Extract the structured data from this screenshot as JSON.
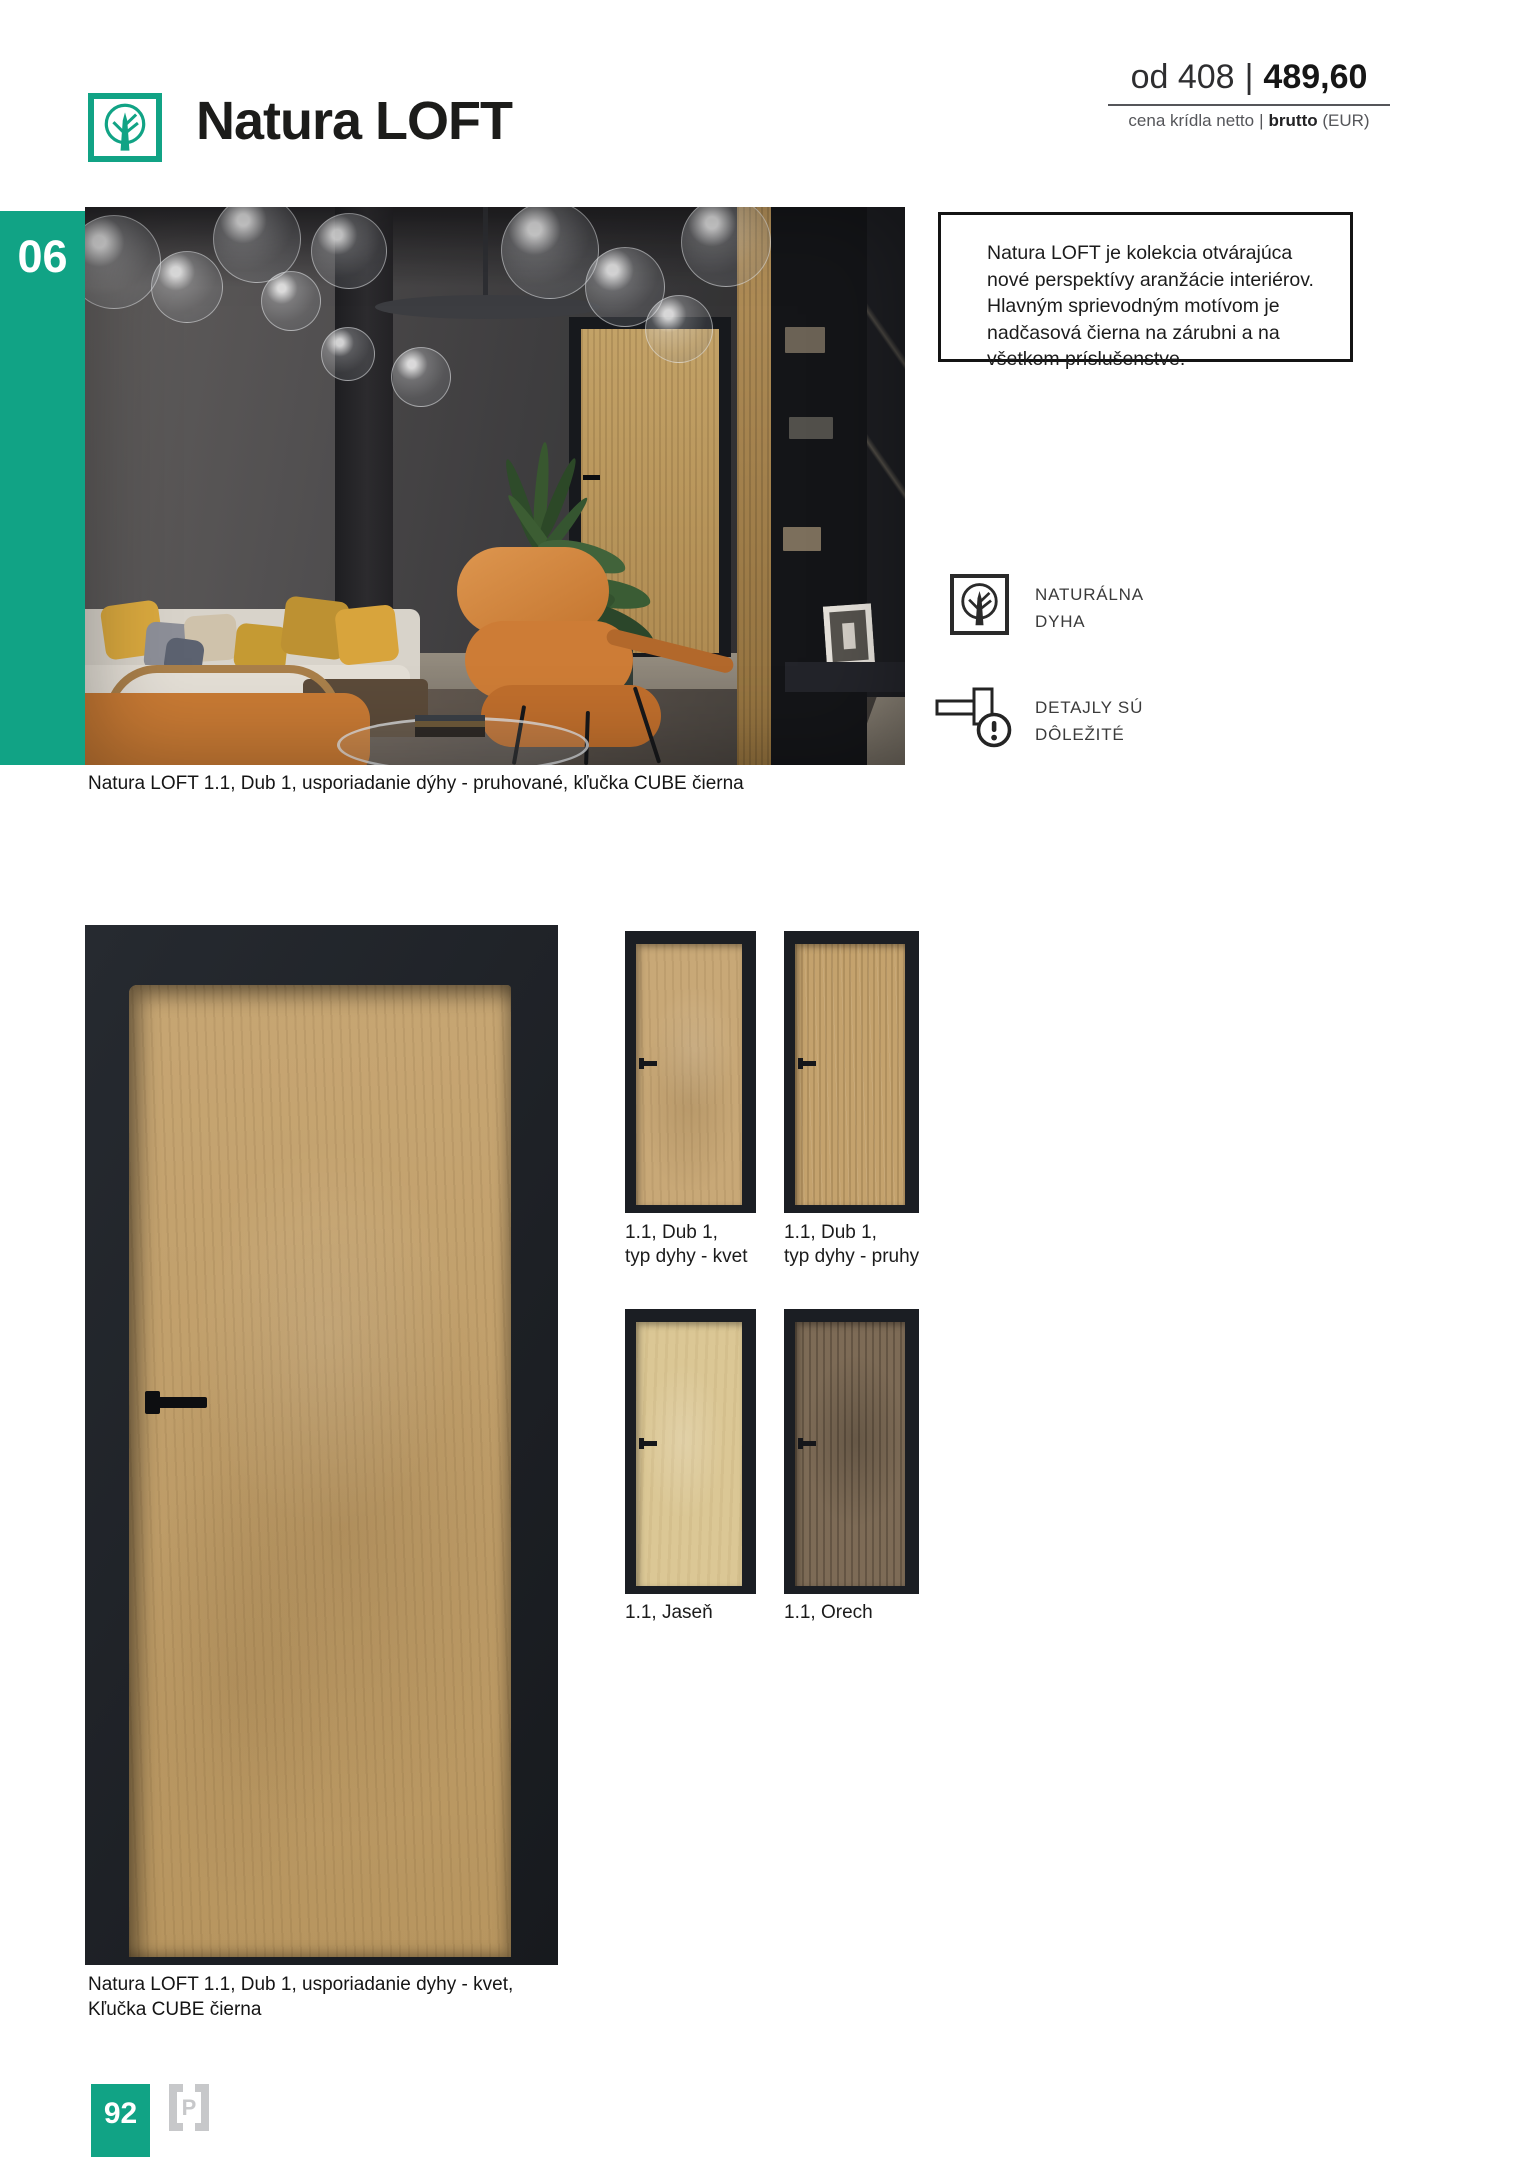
{
  "colors": {
    "accent_teal": "#11a385",
    "frame_black": "#1b1e23",
    "title_ink": "#1c1c1a"
  },
  "header": {
    "title": "Natura LOFT",
    "price": {
      "prefix": "od 408",
      "separator": "|",
      "value_bold": "489,60"
    },
    "price_caption": {
      "regular": "cena krídla netto",
      "separator": "|",
      "bold": "brutto",
      "suffix": "(EUR)"
    }
  },
  "sidebar": {
    "chapter_number": "06"
  },
  "hero": {
    "info_box_text": "Natura LOFT je kolekcia otvárajúca nové perspektívy aranžácie interiérov. Hlavným sprievodným motívom je nadčasová čierna na zárubni a na všetkom príslušenstve.",
    "caption": "Natura LOFT 1.1, Dub 1, usporiadanie dýhy - pruhované, kľučka CUBE čierna",
    "features": [
      {
        "icon": "tree-in-circle-icon",
        "line1": "NATURÁLNA",
        "line2": "DYHA"
      },
      {
        "icon": "door-handle-alert-icon",
        "line1": "DETAJLY SÚ",
        "line2": "DÔLEŽITÉ"
      }
    ]
  },
  "door_figure": {
    "caption_line1": "Natura LOFT 1.1, Dub 1, usporiadanie dyhy - kvet,",
    "caption_line2": "Kľučka CUBE čierna"
  },
  "swatches": [
    {
      "id": "dub-kvet",
      "wood_color": "#c8a877",
      "line1": "1.1, Dub 1,",
      "line2": "typ dyhy - kvet"
    },
    {
      "id": "dub-pruhy",
      "wood_color": "#c4a26d",
      "line1": "1.1, Dub 1,",
      "line2": "typ dyhy - pruhy"
    },
    {
      "id": "jasen",
      "wood_color": "#dbc795",
      "line1": "1.1, Jaseň",
      "line2": ""
    },
    {
      "id": "orech",
      "wood_color": "#7d6b56",
      "line1": "1.1, Orech",
      "line2": ""
    }
  ],
  "footer": {
    "page_number": "92",
    "publisher_initial": "P"
  }
}
